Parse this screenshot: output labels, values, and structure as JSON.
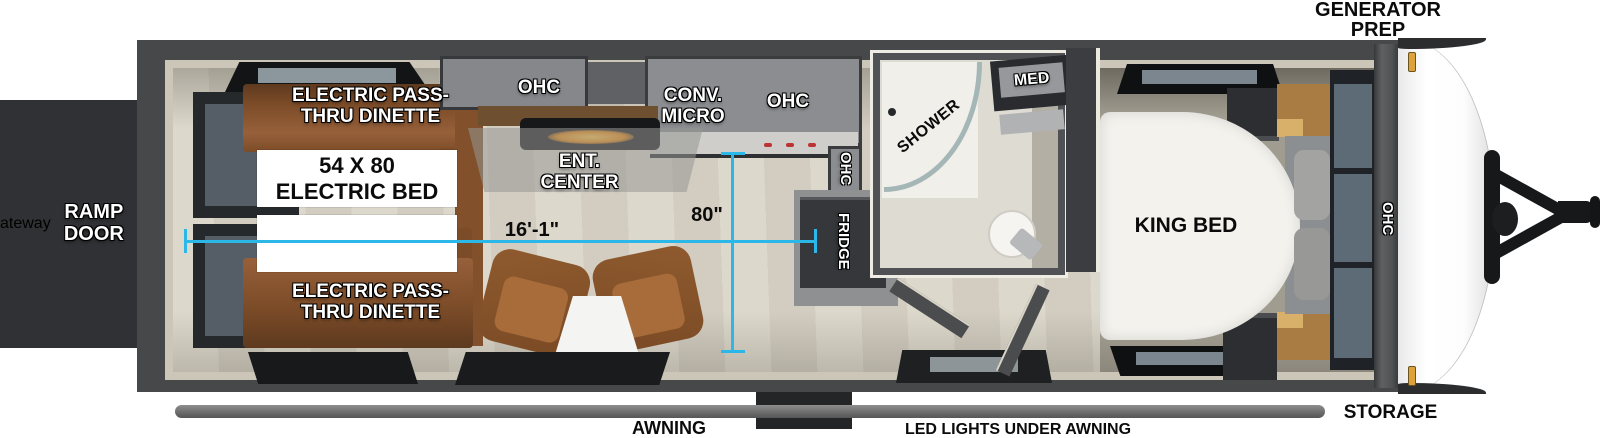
{
  "exterior": {
    "generator_prep": "GENERATOR PREP",
    "ramp_door": "RAMP DOOR",
    "awning": "AWNING",
    "led_lights": "LED LIGHTS UNDER AWNING",
    "storage": "STORAGE"
  },
  "interior": {
    "dinette_top": "ELECTRIC PASS-THRU DINETTE",
    "dinette_bottom": "ELECTRIC PASS-THRU DINETTE",
    "electric_bed": "54 X 80 ELECTRIC BED",
    "ohc_rear": "OHC",
    "conv_micro": "CONV. MICRO",
    "ohc_kitchen": "OHC",
    "ohc_kitchen_side": "OHC",
    "ent_center": "ENT. CENTER",
    "fridge": "FRIDGE",
    "shower": "SHOWER",
    "med": "MED",
    "king_bed": "KING BED",
    "ohc_bedroom": "OHC"
  },
  "dimensions": {
    "interior_length": "16'-1\"",
    "interior_width": "80\""
  },
  "colors": {
    "dimension_line": "#2BB7E8",
    "wall": "#47484A",
    "wall_trim": "#CCC6B8",
    "floor": "#D8D3C7",
    "dinette": "#8A5730",
    "cabinet": "#8B8D90",
    "bed": "#F3F2ED"
  }
}
